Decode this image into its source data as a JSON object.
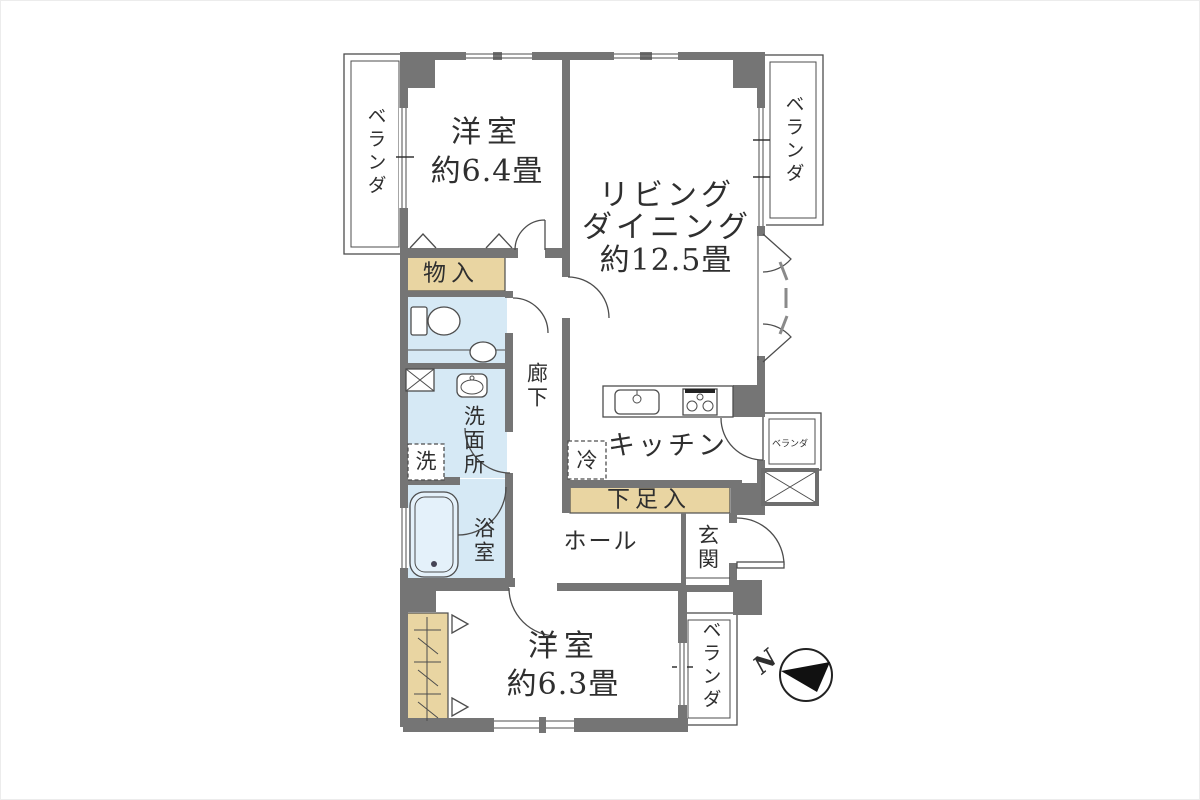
{
  "floorplan": {
    "labels": {
      "veranda_top_left": "ベランダ",
      "bedroom1_name": "洋室",
      "bedroom1_size": "約6.4畳",
      "living_dining_line1": "リビング",
      "living_dining_line2": "ダイニング",
      "living_dining_size": "約12.5畳",
      "veranda_top_right": "ベランダ",
      "storage": "物入",
      "corridor": "廊下",
      "washroom": "洗面所",
      "washing_machine": "洗",
      "bathroom": "浴室",
      "kitchen": "キッチン",
      "refrigerator": "冷",
      "veranda_side": "ベランダ",
      "shoe_cabinet": "下足入",
      "hall": "ホール",
      "entrance": "玄関",
      "bedroom2_name": "洋室",
      "bedroom2_size": "約6.3畳",
      "veranda_bottom": "ベランダ",
      "compass_north": "N"
    },
    "colors": {
      "wall": "#757575",
      "storage": "#e9d5a2",
      "wet": "#d6e9f5",
      "tub": "#e4f1fa",
      "line": "#4d4d4d",
      "text": "#2f2f2f",
      "paper": "#ffffff"
    }
  }
}
